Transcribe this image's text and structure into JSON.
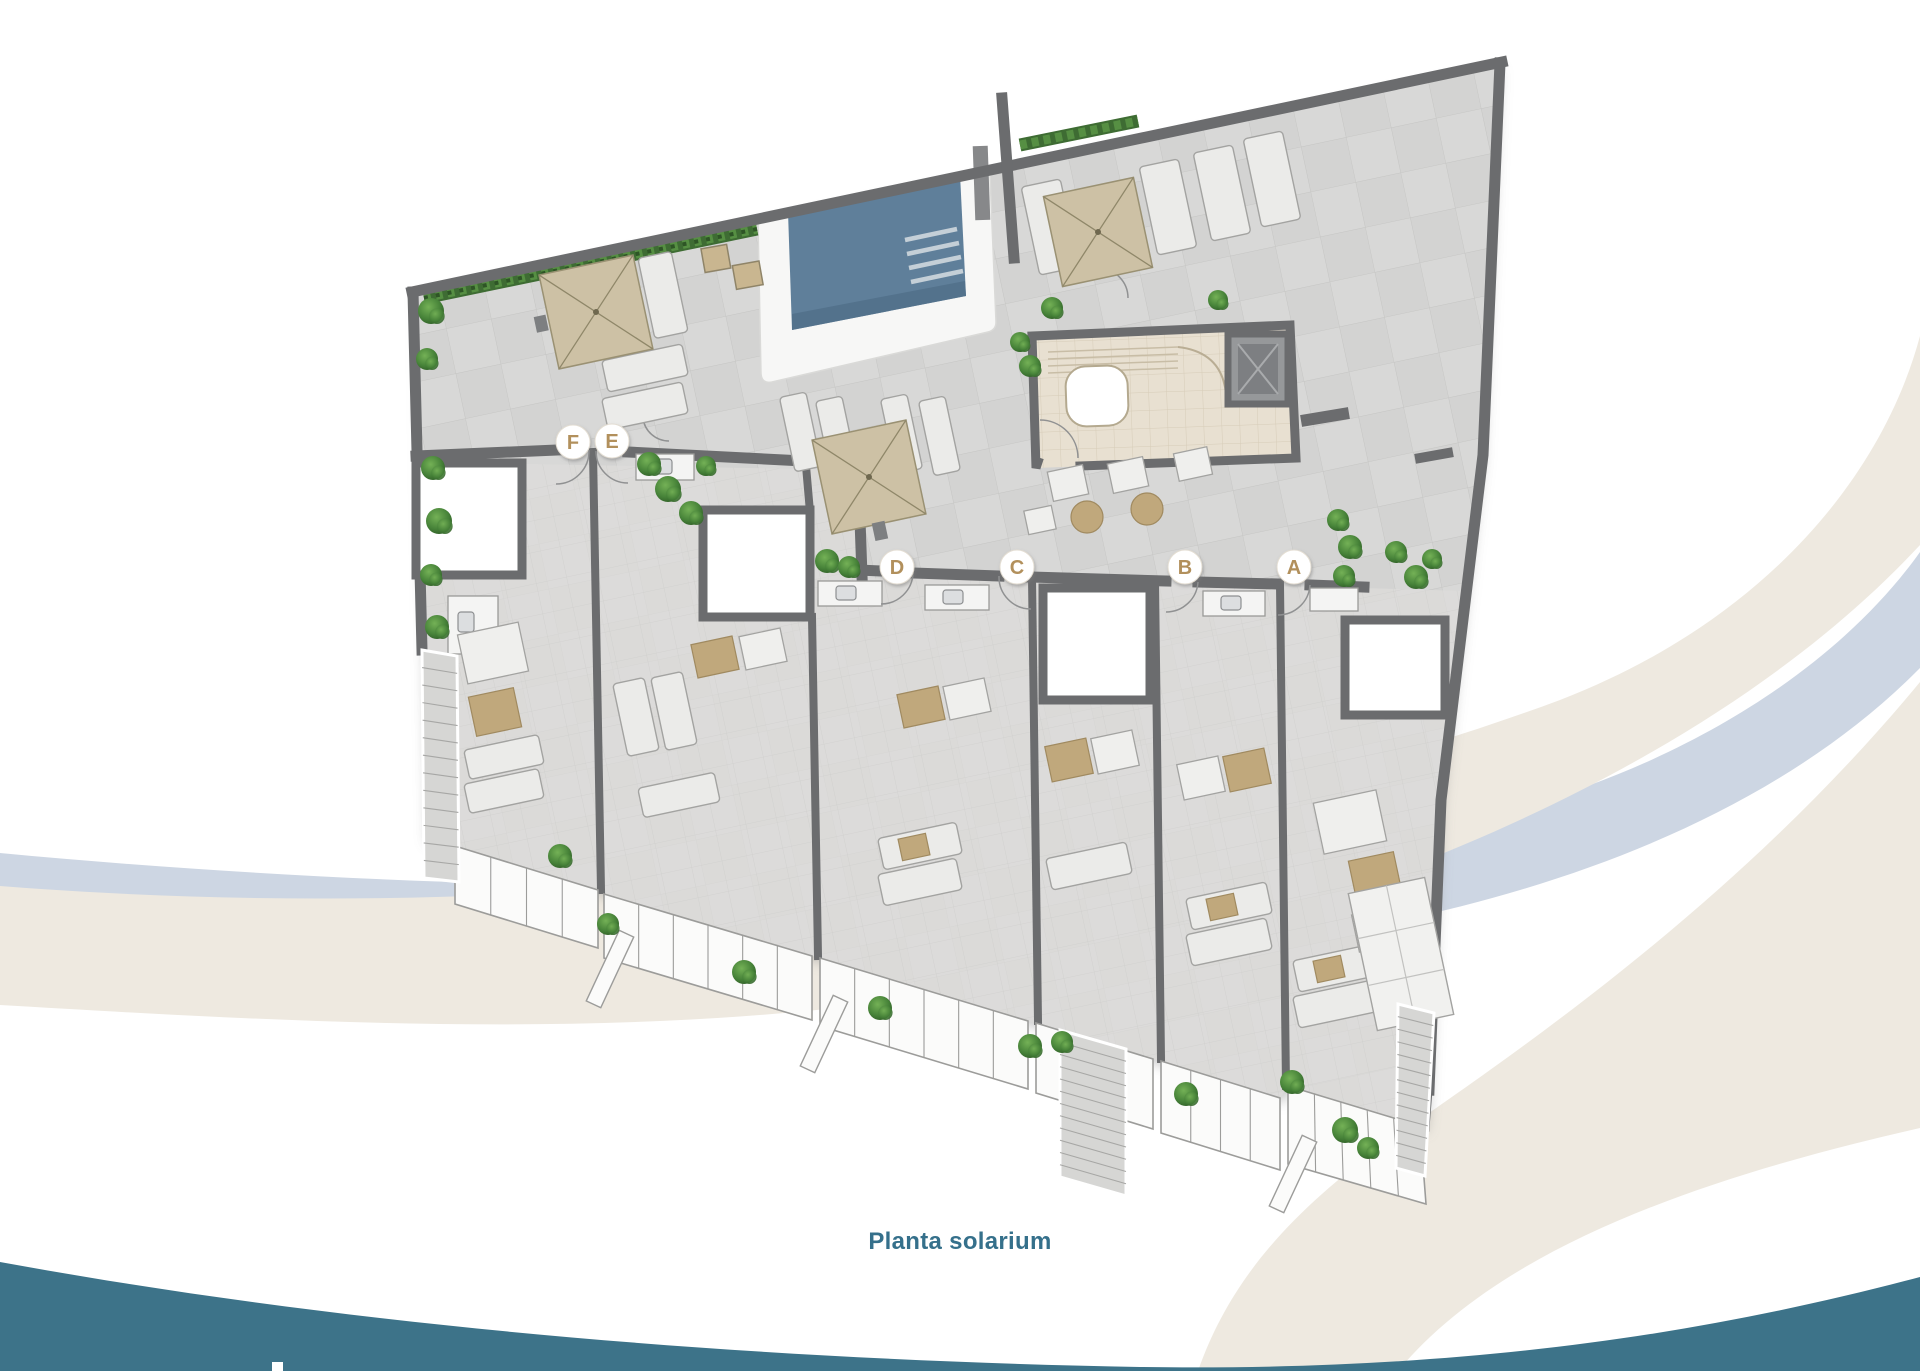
{
  "caption": {
    "text": "Planta solarium"
  },
  "floor_plan": {
    "name": "solarium-roof-plan",
    "unit_labels": [
      {
        "letter": "F",
        "x": 573,
        "y": 442
      },
      {
        "letter": "E",
        "x": 612,
        "y": 441
      },
      {
        "letter": "D",
        "x": 897,
        "y": 567
      },
      {
        "letter": "C",
        "x": 1017,
        "y": 567
      },
      {
        "letter": "B",
        "x": 1185,
        "y": 567
      },
      {
        "letter": "A",
        "x": 1294,
        "y": 567
      }
    ]
  },
  "colors": {
    "caption_text": "#35708b",
    "label_letter": "#b2905c",
    "label_circle": "#ffffff",
    "footer_wave": "#3d7389",
    "wave_beige": "#eee9e0",
    "wave_blue": "#cdd6e3",
    "pool_water": "#5f7f9a",
    "umbrella": "#cdc1a5",
    "wall": "#6b6c6e",
    "floor": "#d8d8d7",
    "hedge": "#3e6c33",
    "bar_floor": "#e8e0d1",
    "balustrade": "#fbfbfa"
  }
}
